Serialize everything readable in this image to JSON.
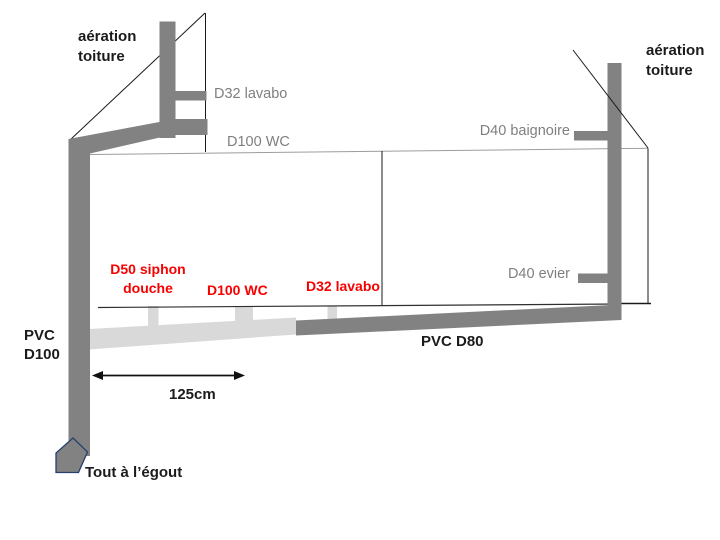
{
  "diagram_title": "plumbing-drainage-schematic",
  "labels": {
    "vent_roof_left": "aération\ntoiture",
    "vent_roof_right": "aération\ntoiture",
    "d32_lavabo_vent": "D32 lavabo",
    "d100_wc_vent": "D100 WC",
    "d40_baignoire": "D40 baignoire",
    "d40_evier": "D40 evier",
    "d50_siphon_douche": "D50 siphon\ndouche",
    "d100_wc_branch": "D100 WC",
    "d32_lavabo_branch": "D32 lavabo",
    "pvc_d100": "PVC\nD100",
    "pvc_d80": "PVC D80",
    "dimension_125": "125cm",
    "sewer_outlet": "Tout à l’égout"
  },
  "colors": {
    "pipe_dark": "#828282",
    "pipe_light": "#d9d9d9",
    "label_gray": "#7f7f7f",
    "label_red": "#f60100",
    "label_black": "#1b1b1b",
    "line_black": "#1a1a1a",
    "line_gray": "#9d9d9d",
    "elbow_stroke": "#27406e",
    "bg": "#ffffff"
  }
}
